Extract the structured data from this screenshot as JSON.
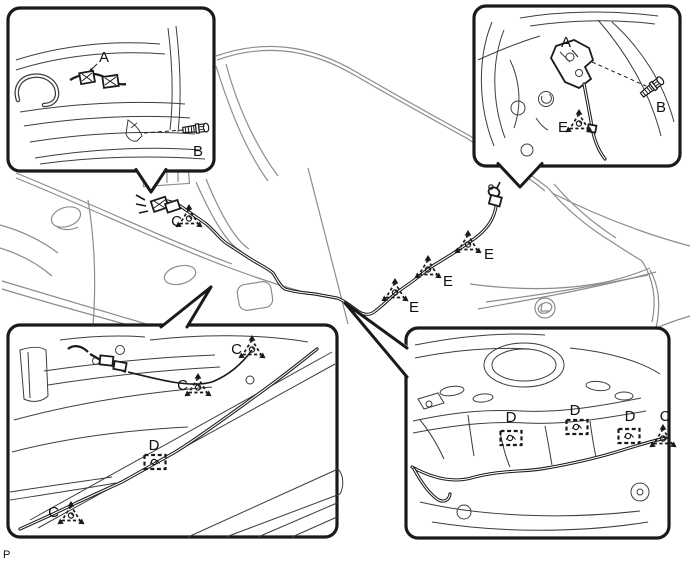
{
  "page_marker": "P",
  "colors": {
    "ink": "#1a1a1a",
    "car_line": "#8c8c8c",
    "detail_line": "#3d3d3d",
    "background": "#ffffff"
  },
  "main_view": {
    "label_c": "C",
    "label_e1": "E",
    "label_e2": "E",
    "label_e3": "E"
  },
  "insets": {
    "top_left": {
      "label_a": "A",
      "label_b": "B"
    },
    "top_right": {
      "label_a": "A",
      "label_b": "B",
      "label_e": "E"
    },
    "bottom_left": {
      "label_c_top": "C",
      "label_c_mid": "C",
      "label_d": "D",
      "label_c_bottom": "C"
    },
    "bottom_right": {
      "label_d1": "D",
      "label_d2": "D",
      "label_d3": "D",
      "label_c": "C"
    }
  }
}
